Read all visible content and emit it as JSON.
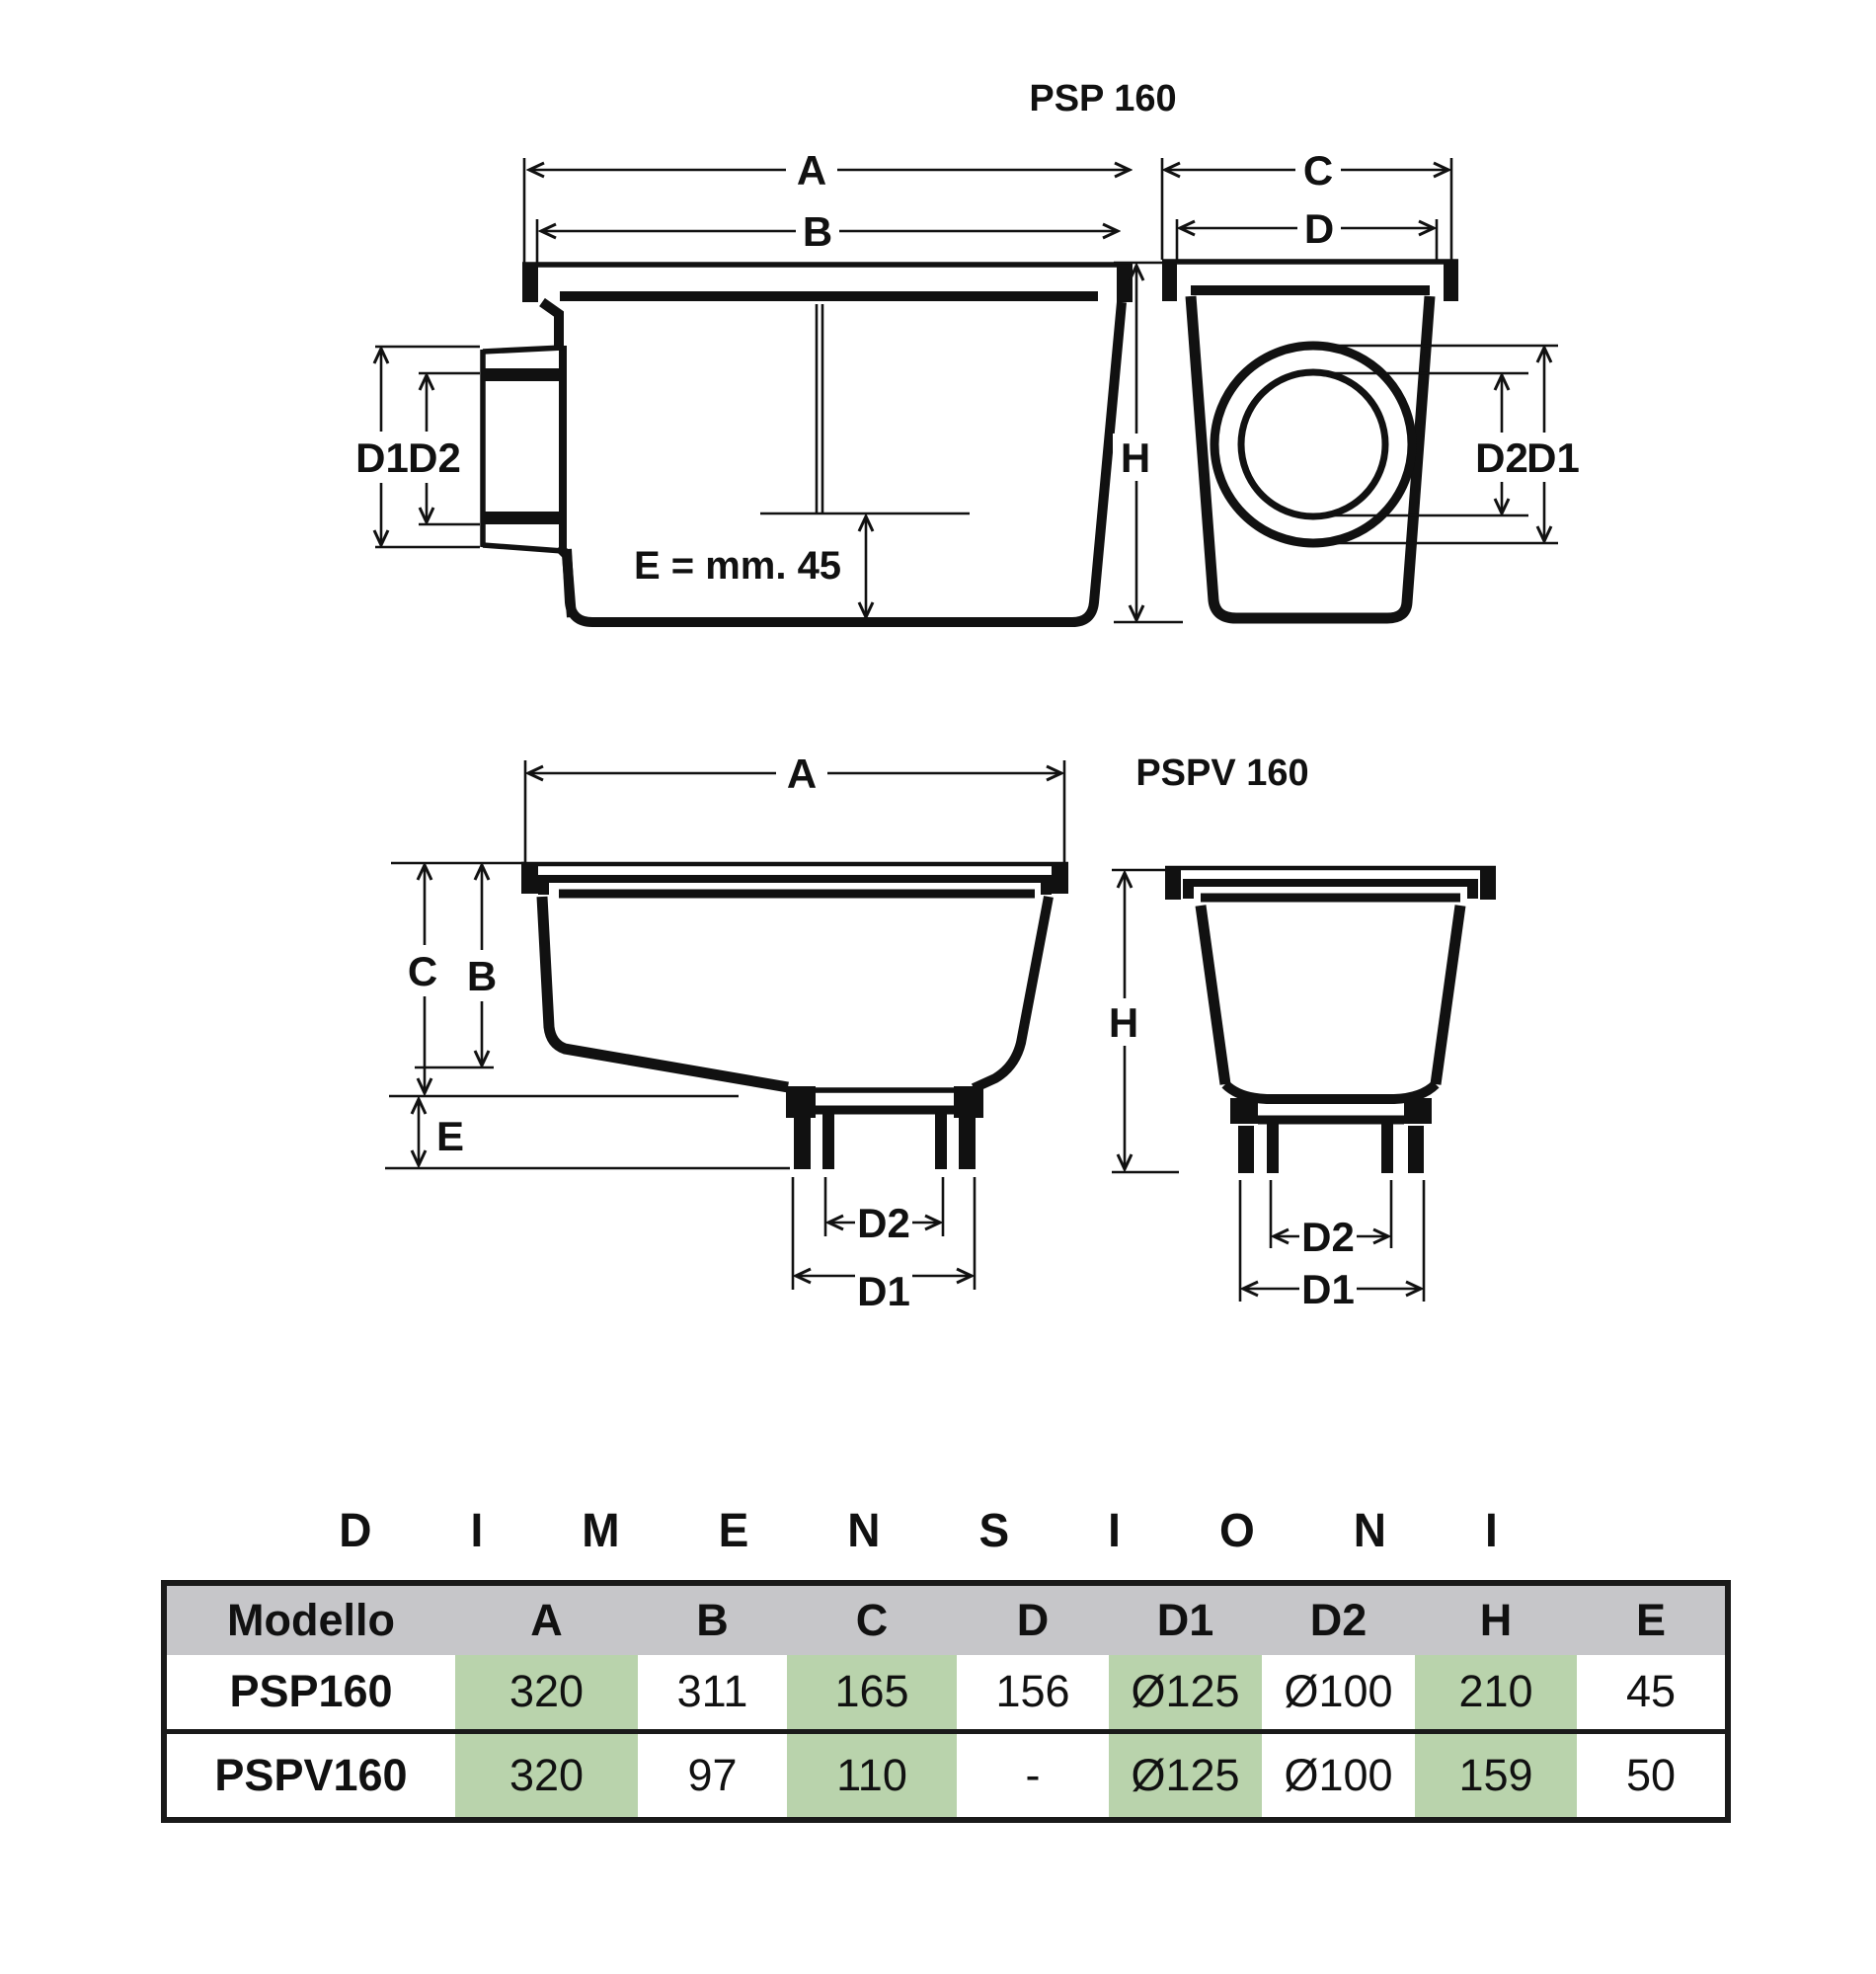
{
  "diagram": {
    "psp": {
      "title": "PSP 160"
    },
    "pspv": {
      "title": "PSPV 160"
    },
    "labels": {
      "a": "A",
      "b": "B",
      "c": "C",
      "d": "D",
      "d1": "D1",
      "d2": "D2",
      "h": "H",
      "e": "E"
    },
    "e_note": "E = mm. 45",
    "ink": "#111111"
  },
  "table": {
    "title": "DIMENSIONI",
    "columns": [
      "Modello",
      "A",
      "B",
      "C",
      "D",
      "D1",
      "D2",
      "H",
      "E"
    ],
    "rows": [
      {
        "model": "PSP160",
        "values": [
          "320",
          "311",
          "165",
          "156",
          "Ø125",
          "Ø100",
          "210",
          "45"
        ]
      },
      {
        "model": "PSPV160",
        "values": [
          "320",
          "97",
          "110",
          "-",
          "Ø125",
          "Ø100",
          "159",
          "50"
        ]
      }
    ],
    "highlight_columns": [
      "A",
      "C",
      "D1",
      "H"
    ],
    "colors": {
      "header_bg": "#c6c6c9",
      "highlight": "#b9d3ac",
      "border": "#1a1a1a",
      "text": "#111111"
    }
  }
}
